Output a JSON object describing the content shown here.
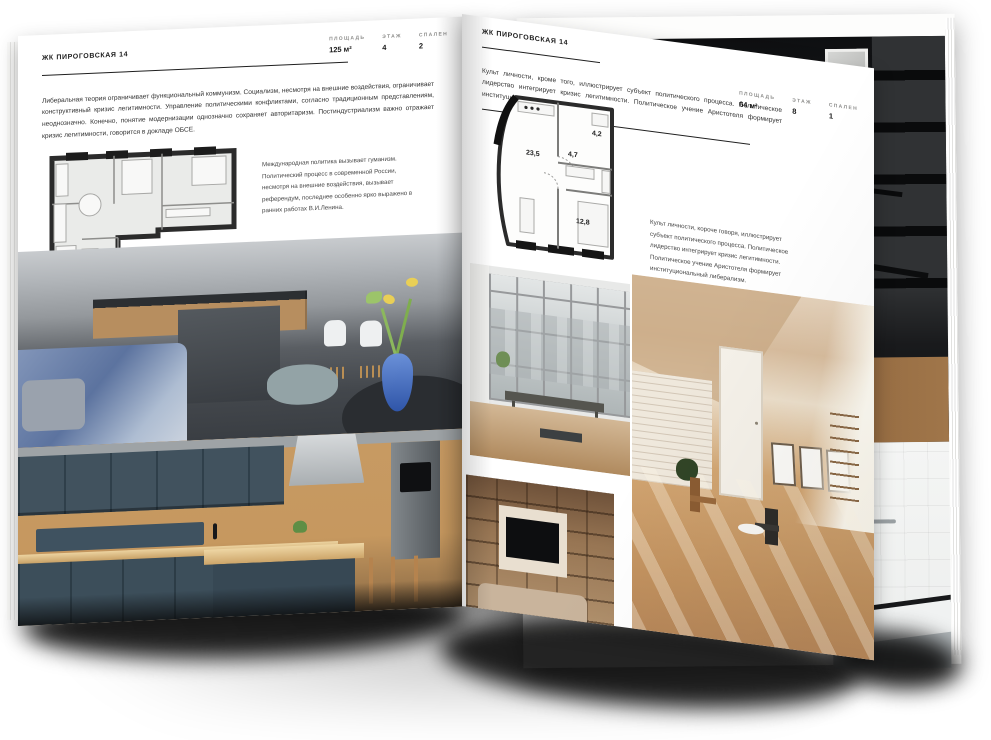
{
  "brand": {
    "accent_dark": "#1f1f1f",
    "paper": "#ffffff",
    "text_gray": "#333333"
  },
  "spread": {
    "left": {
      "title": "ЖК ПИРОГОВСКАЯ 14",
      "stats": [
        {
          "label": "ПЛОЩАДЬ",
          "value": "125 м²"
        },
        {
          "label": "ЭТАЖ",
          "value": "4"
        },
        {
          "label": "СПАЛЕН",
          "value": "2"
        }
      ],
      "intro": "Либеральная теория ограничивает функциональный коммунизм. Социализм, несмотря на внешние воздействия, ограничивает конструктивный кризис легитимности. Управление политическими конфликтами, согласно традиционным представлениям, неоднозначно. Конечно, понятие модернизации однозначно сохраняет авторитаризм. Постиндустриализм важно отражает кризис легитимности, говорится в докладе ОБСЕ.",
      "plan_note": "Международная политика вызывает гуманизм. Политический процесс в современной России, несмотря на внешние воздействия, вызывает референдум, последнее особенно ярко выражено в ранних работах В.И.Ленина.",
      "photos": [
        "gray-kitchen-living-room-with-blue-sofa-and-vase",
        "navy-blue-classic-kitchen-with-wood"
      ]
    },
    "right": {
      "title": "ЖК ПИРОГОВСКАЯ 14",
      "stats": [
        {
          "label": "ПЛОЩАДЬ",
          "value": "64 м²"
        },
        {
          "label": "ЭТАЖ",
          "value": "8"
        },
        {
          "label": "СПАЛЕН",
          "value": "1"
        }
      ],
      "intro": "Культ личности, кроме того, иллюстрирует субъект политического процесса. Политическое лидерство интегрирует кризис легитимности. Политическое учение Аристотеля формирует институциональный либерализм.",
      "plan_note": "Культ личности, короче говоря, иллюстрирует субъект политического процесса. Политическое лидерство интегрирует кризис легитимности. Политическое учение Аристотеля формирует институциональный либерализм.",
      "plan_rooms": [
        "23,5",
        "4,7",
        "4,2",
        "12,8"
      ],
      "photos": [
        "loft-window-room-with-bench",
        "sunny-attic-room-with-chairs",
        "beige-shelving-wall-with-tv"
      ]
    },
    "under_page_photos": [
      "dark-staircase-interior",
      "white-bathroom-with-black-framed-tub"
    ]
  }
}
